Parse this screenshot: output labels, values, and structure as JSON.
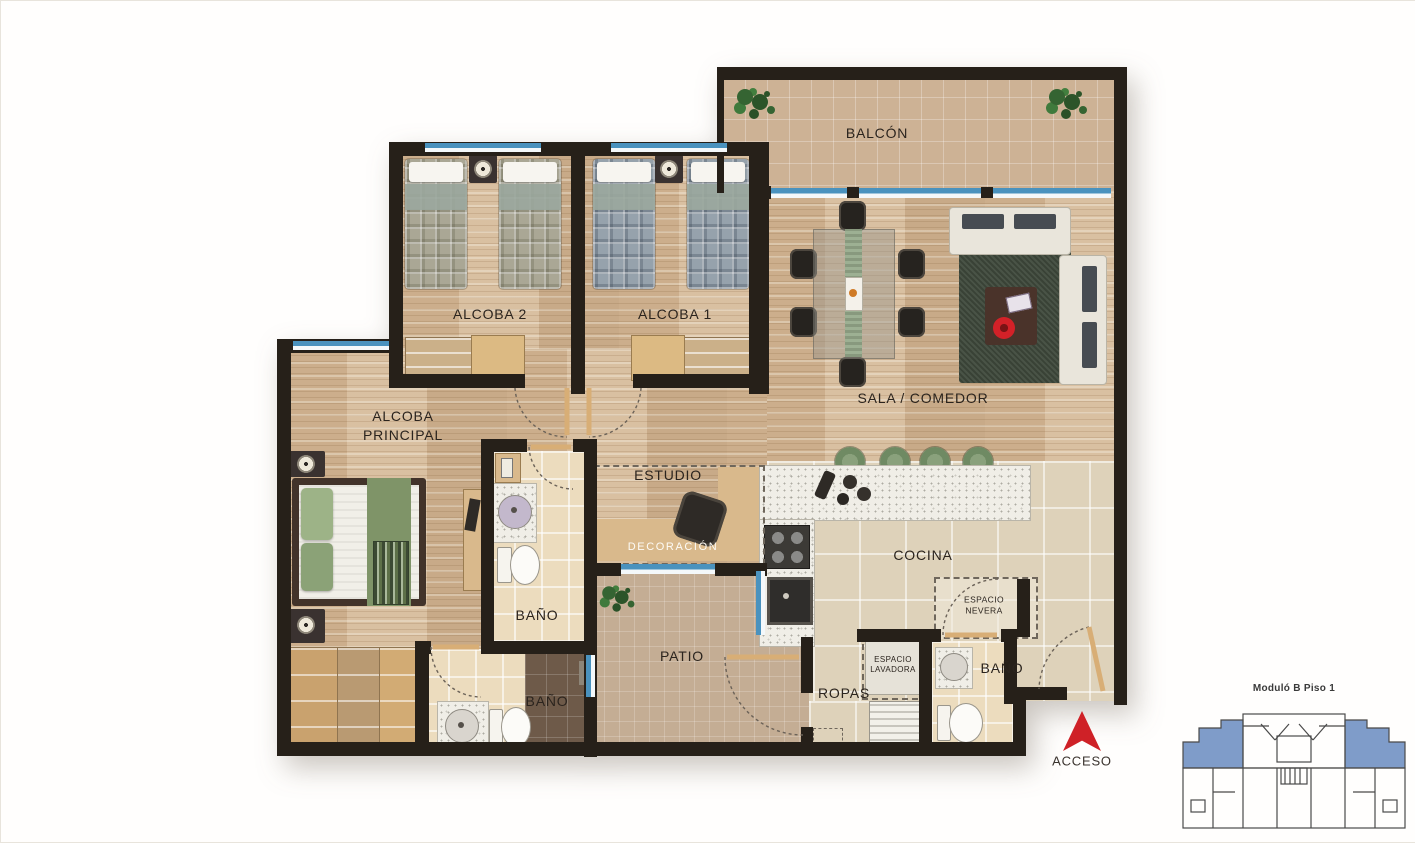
{
  "plan": {
    "rooms": {
      "balcon": {
        "label": "BALCÓN"
      },
      "alcoba2": {
        "label": "ALCOBA 2"
      },
      "alcoba1": {
        "label": "ALCOBA 1"
      },
      "sala_comedor": {
        "label": "SALA / COMEDOR"
      },
      "alcoba_principal": {
        "label_line1": "ALCOBA",
        "label_line2": "PRINCIPAL"
      },
      "estudio": {
        "label": "ESTUDIO"
      },
      "decoracion": {
        "label": "DECORACIÓN"
      },
      "bano_principal": {
        "label": "BAÑO"
      },
      "bano_auxiliar": {
        "label": "BAÑO"
      },
      "bano_social": {
        "label": "BAÑO"
      },
      "cocina": {
        "label": "COCINA"
      },
      "patio": {
        "label": "PATIO"
      },
      "ropas": {
        "label": "ROPAS"
      },
      "espacio_nevera": {
        "line1": "ESPACIO",
        "line2": "NEVERA"
      },
      "espacio_lavadora": {
        "line1": "ESPACIO",
        "line2": "LAVADORA"
      }
    },
    "access": {
      "label": "ACCESO"
    },
    "minimap": {
      "title": "Moduló B Piso 1"
    },
    "colors": {
      "wall": "#262019",
      "window_blue": "#4a92be",
      "access_red": "#cf2127",
      "minimap_blue": "#7f9cc9",
      "label_dark": "#2b241e",
      "wood_base": "#d3b796",
      "tile_beige": "#ded2ba",
      "tile_cream": "#ecdcbe",
      "balcony_tan": "#cdb295",
      "patio_tan": "#c4ad94"
    }
  }
}
